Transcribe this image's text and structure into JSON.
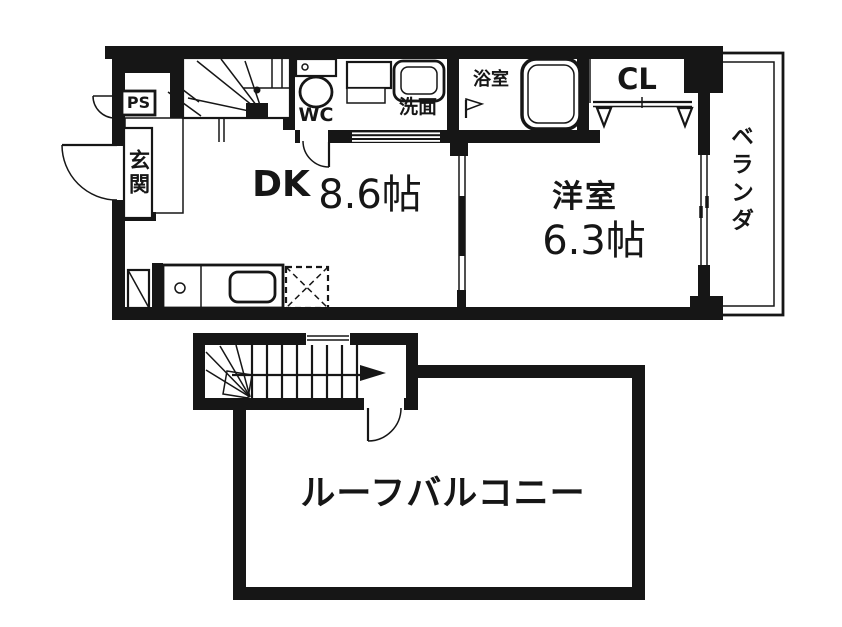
{
  "colors": {
    "ink": "#161616",
    "paper": "#ffffff"
  },
  "upper_floor": {
    "rooms": {
      "pipe_space": "PS",
      "entrance": "玄関",
      "toilet": "WC",
      "washroom": "洗面",
      "bathroom": "浴室",
      "closet": "CL",
      "veranda": "ベランダ",
      "dining_kitchen": "DK",
      "dining_kitchen_size": "8.6帖",
      "western_room": "洋室",
      "western_room_size": "6.3帖"
    }
  },
  "lower_floor": {
    "rooms": {
      "roof_balcony": "ルーフバルコニー"
    }
  }
}
